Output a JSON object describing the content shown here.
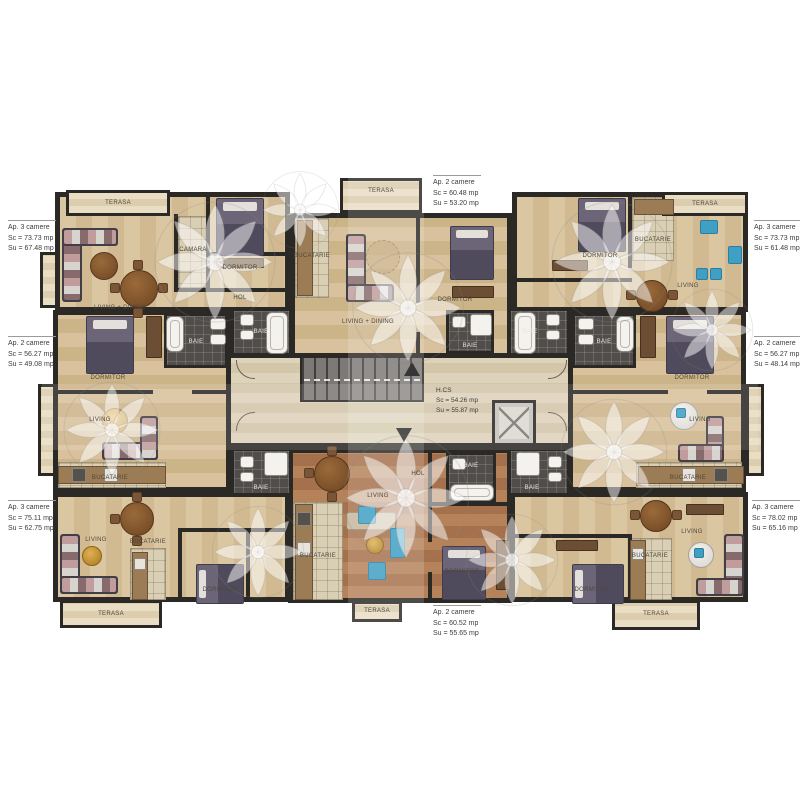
{
  "plan_title": "Etaj curent - plan apartamente",
  "annotations": {
    "top_left": [
      "Ap. 3 camere",
      "Sc = 73.73 mp",
      "Su = 67.48 mp"
    ],
    "top_center": [
      "Ap. 2 camere",
      "Sc = 60.48 mp",
      "Su = 53.20 mp"
    ],
    "top_right": [
      "Ap. 3 camere",
      "Sc = 73.73 mp",
      "Su = 61.48 mp"
    ],
    "mid_left": [
      "Ap. 2 camere",
      "Sc = 56.27 mp",
      "Su = 49.08 mp"
    ],
    "mid_right": [
      "Ap. 2 camere",
      "Sc = 56.27 mp",
      "Su = 48.14 mp"
    ],
    "bottom_left": [
      "Ap. 3 camere",
      "Sc = 75.11 mp",
      "Su = 62.75 mp"
    ],
    "bottom_center": [
      "Ap. 2 camere",
      "Sc = 60.52 mp",
      "Su = 55.65 mp"
    ],
    "bottom_right": [
      "Ap. 3 camere",
      "Sc = 78.02 mp",
      "Su = 65.16 mp"
    ],
    "corridor": [
      "H.CS",
      "Sc = 54.26 mp",
      "Su = 55.87 mp"
    ]
  },
  "rooms": {
    "terasa": "TERASA",
    "dormitor": "DORMITOR",
    "living": "LIVING",
    "living_dining": "LIVING + DINING",
    "bucatarie": "BUCATARIE",
    "baie": "BAIE",
    "camara": "CAMARA",
    "hol": "HOL"
  },
  "colors": {
    "wall": "#2b2926",
    "wood_light": "#d5bd97",
    "wood_red": "#ad7852",
    "tile_dark": "#504d4b",
    "corridor_floor": "#d8cdb2",
    "accent_teal": "#3f9fc4",
    "gold": "#c79a3a",
    "watermark": "#f3f2f0"
  }
}
